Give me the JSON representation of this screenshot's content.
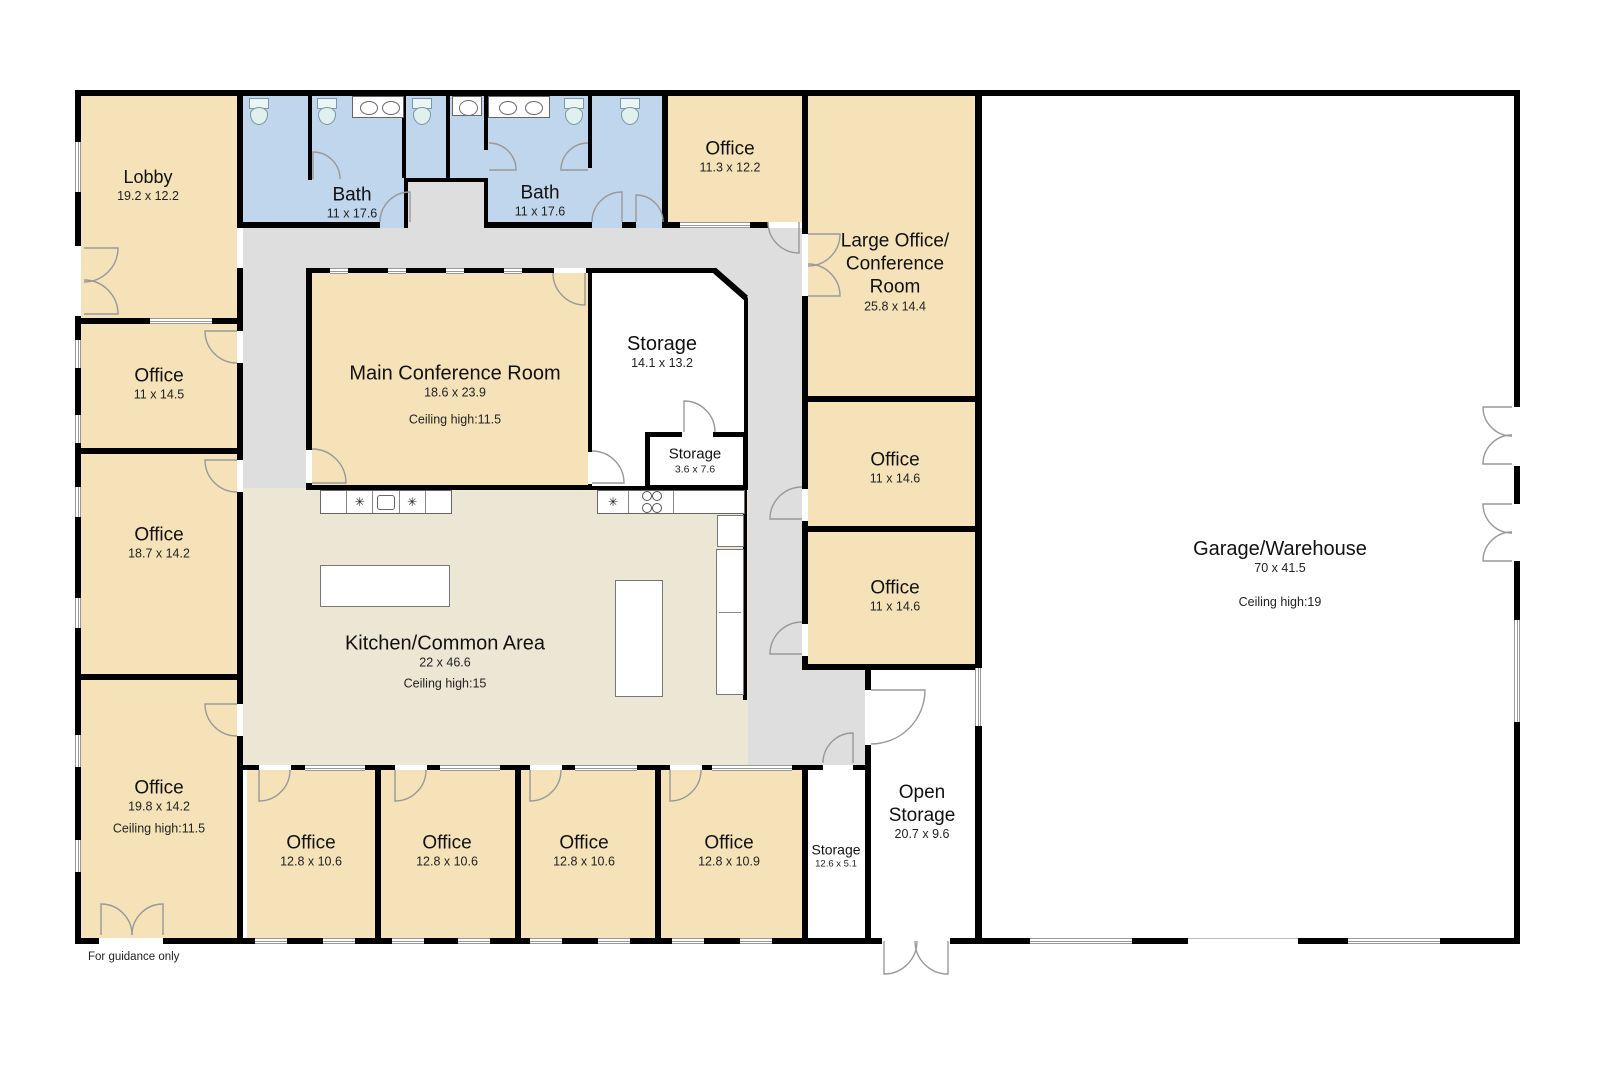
{
  "note": "For guidance only",
  "colors": {
    "wall": "#000000",
    "office_fill": "#f5e2b8",
    "bath_fill": "#bfd6ec",
    "corridor_fill": "#dedede",
    "kitchen_fill": "#ece6d4",
    "storage_fill": "#ffffff",
    "door_arc": "#999999",
    "text": "#1a1a1a"
  },
  "icons": {
    "burner_glyph": "✳"
  },
  "rooms": {
    "lobby": {
      "name": "Lobby",
      "dims": "19.2 x 12.2"
    },
    "bath_left": {
      "name": "Bath",
      "dims": "11 x 17.6"
    },
    "bath_right": {
      "name": "Bath",
      "dims": "11 x 17.6"
    },
    "office_top": {
      "name": "Office",
      "dims": "11.3 x 12.2"
    },
    "large_office": {
      "name_lines": [
        "Large Office/",
        "Conference",
        "Room"
      ],
      "dims": "25.8 x 14.4"
    },
    "main_conference": {
      "name": "Main Conference Room",
      "dims": "18.6 x 23.9",
      "ceiling": "Ceiling high:11.5"
    },
    "storage_main": {
      "name": "Storage",
      "dims": "14.1 x 13.2"
    },
    "storage_small": {
      "name": "Storage",
      "dims": "3.6 x 7.6"
    },
    "office_left_1": {
      "name": "Office",
      "dims": "11 x 14.5"
    },
    "office_left_2": {
      "name": "Office",
      "dims": "18.7 x 14.2"
    },
    "office_left_3": {
      "name": "Office",
      "dims": "19.8 x 14.2",
      "ceiling": "Ceiling high:11.5"
    },
    "kitchen": {
      "name": "Kitchen/Common Area",
      "dims": "22 x 46.6",
      "ceiling": "Ceiling high:15"
    },
    "office_right_1": {
      "name": "Office",
      "dims": "11 x 14.6"
    },
    "office_right_2": {
      "name": "Office",
      "dims": "11 x 14.6"
    },
    "office_bottom_1": {
      "name": "Office",
      "dims": "12.8 x 10.6"
    },
    "office_bottom_2": {
      "name": "Office",
      "dims": "12.8 x 10.6"
    },
    "office_bottom_3": {
      "name": "Office",
      "dims": "12.8 x 10.6"
    },
    "office_bottom_4": {
      "name": "Office",
      "dims": "12.8 x 10.9"
    },
    "storage_hall": {
      "name": "Storage",
      "dims": "12.6 x 5.1"
    },
    "open_storage": {
      "name_lines": [
        "Open",
        "Storage"
      ],
      "dims": "20.7 x 9.6"
    },
    "garage": {
      "name": "Garage/Warehouse",
      "dims": "70 x 41.5",
      "ceiling": "Ceiling high:19"
    }
  }
}
